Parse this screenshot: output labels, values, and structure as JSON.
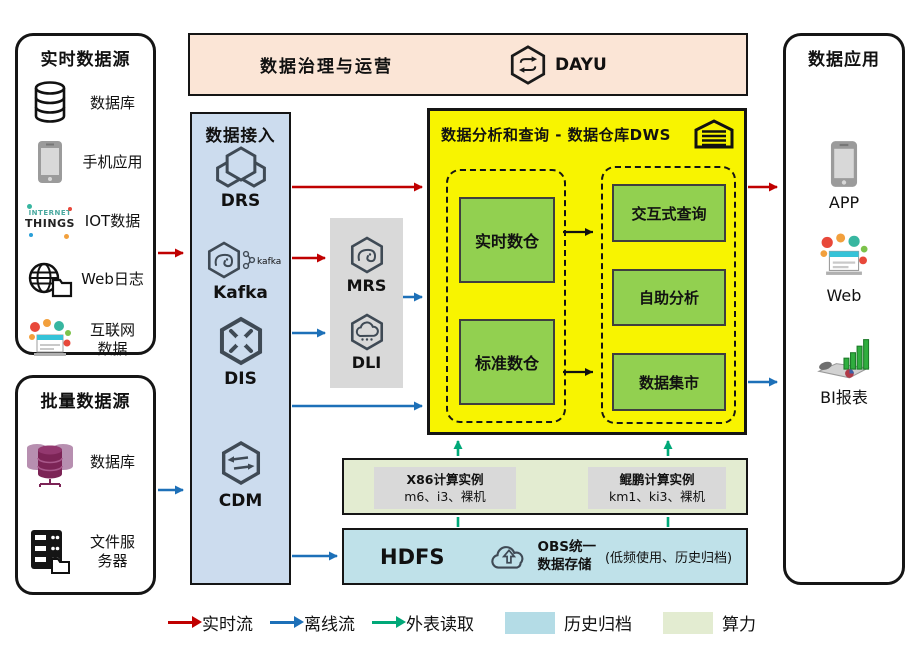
{
  "realtime_sources": {
    "title": "实时数据源",
    "items": [
      {
        "label": "数据库",
        "icon": "database-icon"
      },
      {
        "label": "手机应用",
        "icon": "phone-icon"
      },
      {
        "label": "IOT数据",
        "icon": "iot-wordcloud-icon"
      },
      {
        "label": "Web日志",
        "icon": "globe-folder-icon"
      },
      {
        "label": "互联网数据",
        "icon": "internet-bubbles-icon"
      }
    ]
  },
  "batch_sources": {
    "title": "批量数据源",
    "items": [
      {
        "label": "数据库",
        "icon": "database-cluster-icon"
      },
      {
        "label": "文件服务器",
        "icon": "file-server-icon"
      }
    ]
  },
  "governance": {
    "title": "数据治理与运营",
    "product": "DAYU"
  },
  "data_access": {
    "title": "数据接入",
    "services": [
      {
        "name": "DRS"
      },
      {
        "name": "Kafka",
        "logo_text": "kafka"
      },
      {
        "name": "DIS"
      },
      {
        "name": "CDM"
      }
    ]
  },
  "processing": {
    "services": [
      {
        "name": "MRS"
      },
      {
        "name": "DLI"
      }
    ]
  },
  "dws": {
    "title": "数据分析和查询 - 数据仓库DWS",
    "warehouses": [
      {
        "label": "实时数仓"
      },
      {
        "label": "标准数仓"
      }
    ],
    "services": [
      {
        "label": "交互式查询"
      },
      {
        "label": "自助分析"
      },
      {
        "label": "数据集市"
      }
    ]
  },
  "compute": {
    "instances": [
      {
        "title": "X86计算实例",
        "spec": "m6、i3、裸机"
      },
      {
        "title": "鲲鹏计算实例",
        "spec": "km1、ki3、裸机"
      }
    ]
  },
  "storage": {
    "hdfs_label": "HDFS",
    "obs_line1": "OBS统一",
    "obs_line2": "数据存储",
    "note": "(低频使用、历史归档)"
  },
  "apps": {
    "title": "数据应用",
    "items": [
      {
        "label": "APP"
      },
      {
        "label": "Web"
      },
      {
        "label": "BI报表"
      }
    ]
  },
  "icons": {
    "iot_line1": "INTERNET",
    "iot_line2": "THINGS"
  },
  "legend": {
    "items": [
      {
        "label": "实时流",
        "type": "arrow",
        "color": "#c00000"
      },
      {
        "label": "离线流",
        "type": "arrow",
        "color": "#1d70b8"
      },
      {
        "label": "外表读取",
        "type": "arrow",
        "color": "#00a878"
      },
      {
        "label": "历史归档",
        "type": "swatch",
        "color": "#b4dce6"
      },
      {
        "label": "算力",
        "type": "swatch",
        "color": "#e3ecd1"
      }
    ]
  },
  "colors": {
    "realtime_flow": "#c00000",
    "offline_flow": "#1d70b8",
    "external_read": "#00a878",
    "dws_bg": "#f8f400",
    "warehouse_green": "#92d050",
    "access_bg": "#ccdcee",
    "hdfs_bg": "#bfe1e9",
    "compute_bg": "#e3ecd1",
    "governance_bg": "#fbe5d6",
    "gray_panel": "#d9d9d9"
  }
}
